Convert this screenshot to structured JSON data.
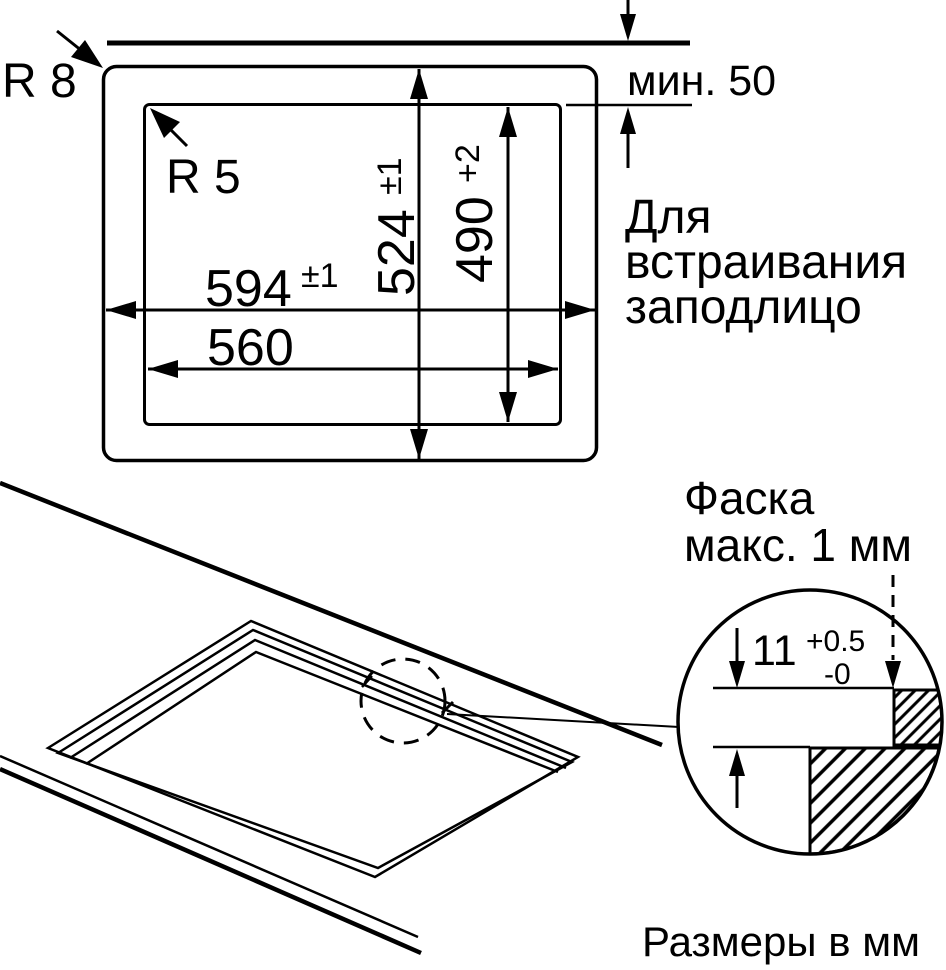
{
  "colors": {
    "ink": "#000000",
    "background": "#ffffff"
  },
  "plan": {
    "corner_radius_outer": "R 8",
    "corner_radius_inner": "R 5",
    "width_outer_value": "594",
    "width_outer_tol": "±1",
    "width_inner_value": "560",
    "height_outer_value": "524",
    "height_outer_tol": "±1",
    "height_inner_value": "490",
    "height_inner_tol": "+2",
    "edge_min_distance": "мин. 50",
    "flush_note": [
      "Для",
      "встраивания",
      "заподлицо"
    ]
  },
  "detail": {
    "chamfer_line1": "Фаска",
    "chamfer_line2": "макс. 1 мм",
    "depth_value": "11",
    "depth_tol_plus": "+0.5",
    "depth_tol_minus": "-0"
  },
  "footer": {
    "units": "Размеры в мм"
  }
}
